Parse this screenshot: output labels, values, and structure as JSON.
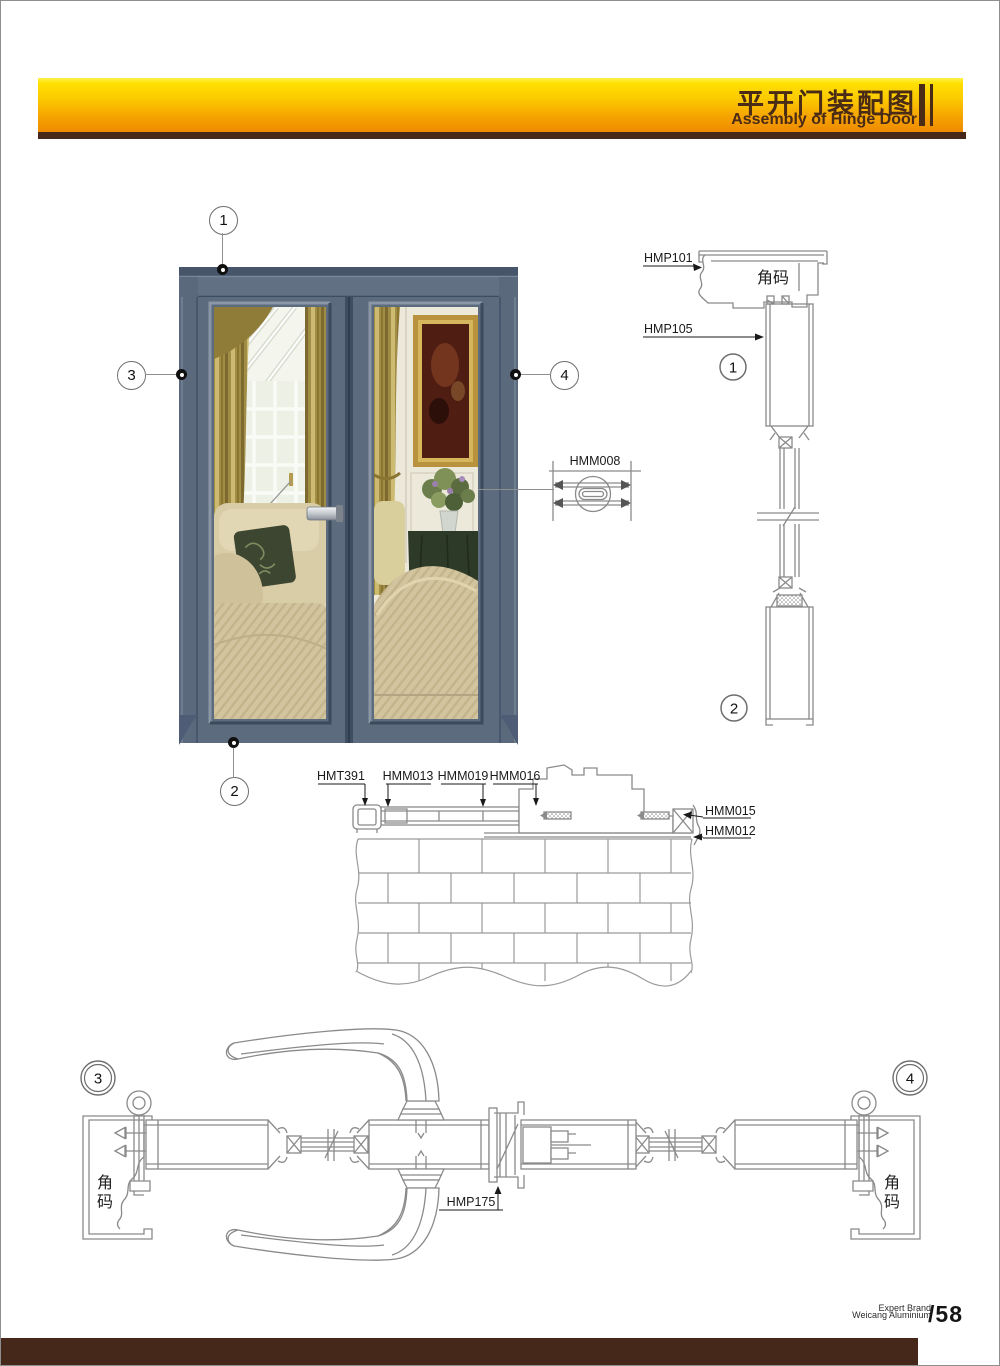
{
  "header": {
    "title_zh": "平开门装配图",
    "title_en": "Assembly of Hinge Door"
  },
  "door_figure": {
    "callout_top": "1",
    "callout_bottom": "2",
    "callout_left": "3",
    "callout_right": "4"
  },
  "detail_hmm008": {
    "label": "HMM008"
  },
  "vertical_section": {
    "label_hmp101": "HMP101",
    "label_hmp105": "HMP105",
    "corner_code": "角码",
    "callout_head": "1",
    "callout_sill": "2"
  },
  "threshold_section": {
    "label_hmt391": "HMT391",
    "label_hmm013": "HMM013",
    "label_hmm019": "HMM019",
    "label_hmm016": "HMM016",
    "label_hmm015": "HMM015",
    "label_hmm012": "HMM012"
  },
  "horizontal_section": {
    "callout_left": "3",
    "callout_right": "4",
    "label_hmp175": "HMP175",
    "corner_code_left": [
      "角",
      "码"
    ],
    "corner_code_right": [
      "角",
      "码"
    ]
  },
  "footer": {
    "brand_line1": "Expert Brand",
    "brand_line2": "Weicang Aluminium",
    "page_number": "/58"
  },
  "colors": {
    "header_gradient_top": "#ffe000",
    "header_gradient_bottom": "#ee8a00",
    "header_text": "#4a2b16",
    "brown_bar": "#46281a",
    "drawing_stroke": "#8c8c8c",
    "door_frame": "#5d6b7e"
  }
}
